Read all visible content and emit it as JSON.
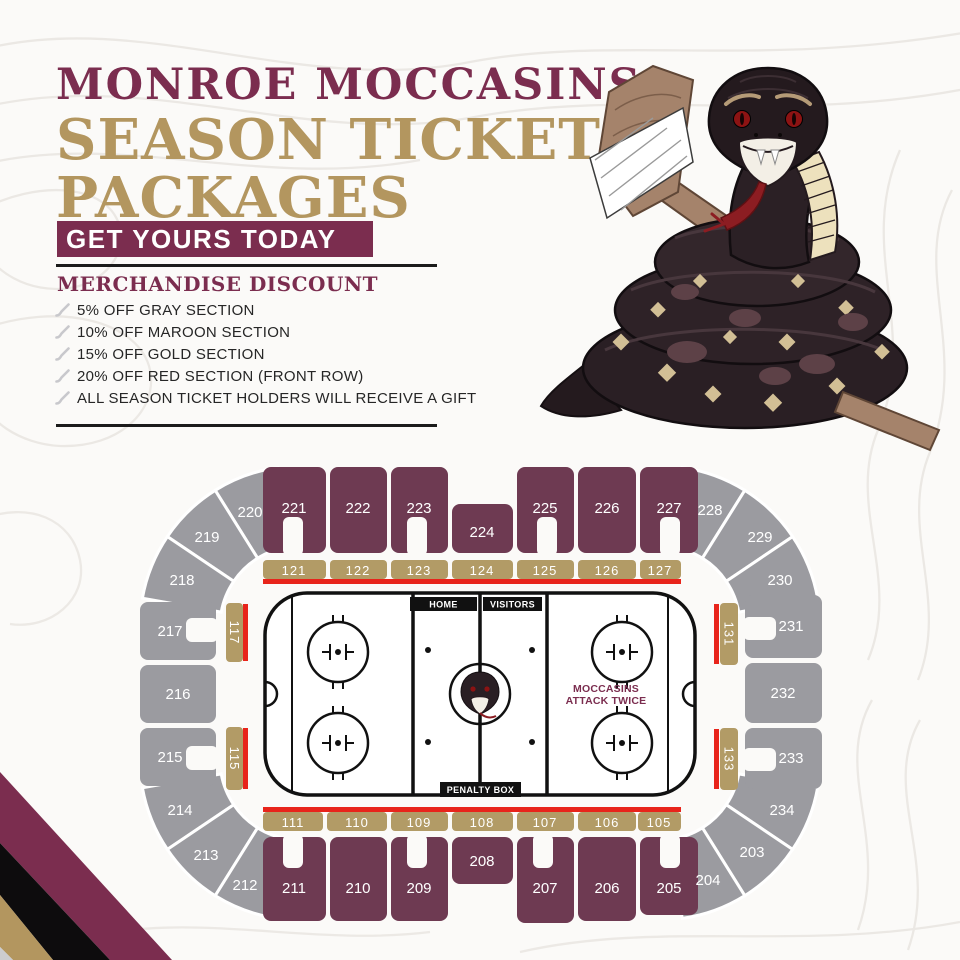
{
  "header": {
    "team": "MONROE MOCCASINS",
    "title_line1": "SEASON TICKET",
    "title_line2": "PACKAGES",
    "banner": "GET YOURS TODAY"
  },
  "discount": {
    "heading": "MERCHANDISE DISCOUNT",
    "items": [
      "5% OFF GRAY SECTION",
      "10% OFF MAROON SECTION",
      "15% OFF GOLD SECTION",
      "20% OFF RED SECTION (FRONT ROW)",
      "ALL SEASON TICKET HOLDERS WILL RECEIVE A GIFT"
    ]
  },
  "rink": {
    "home": "HOME",
    "visitors": "VISITORS",
    "penalty_box": "PENALTY BOX",
    "slogan_line1": "MOCCASINS",
    "slogan_line2": "ATTACK TWICE"
  },
  "sections": {
    "105": "105",
    "106": "106",
    "107": "107",
    "108": "108",
    "109": "109",
    "110": "110",
    "111": "111",
    "115": "115",
    "117": "117",
    "121": "121",
    "122": "122",
    "123": "123",
    "124": "124",
    "125": "125",
    "126": "126",
    "127": "127",
    "131": "131",
    "133": "133",
    "203": "203",
    "204": "204",
    "205": "205",
    "206": "206",
    "207": "207",
    "208": "208",
    "209": "209",
    "210": "210",
    "211": "211",
    "212": "212",
    "213": "213",
    "214": "214",
    "215": "215",
    "216": "216",
    "217": "217",
    "218": "218",
    "219": "219",
    "220": "220",
    "221": "221",
    "222": "222",
    "223": "223",
    "224": "224",
    "225": "225",
    "226": "226",
    "227": "227",
    "228": "228",
    "229": "229",
    "230": "230",
    "231": "231",
    "232": "232",
    "233": "233",
    "234": "234"
  },
  "colors": {
    "maroon": "#7b2d4f",
    "section_maroon": "#6e3a52",
    "gold": "#b3965f",
    "section_gold": "#b29b66",
    "gray": "#9b9ba0",
    "front_row_red": "#e8241b",
    "ink": "#111111"
  }
}
